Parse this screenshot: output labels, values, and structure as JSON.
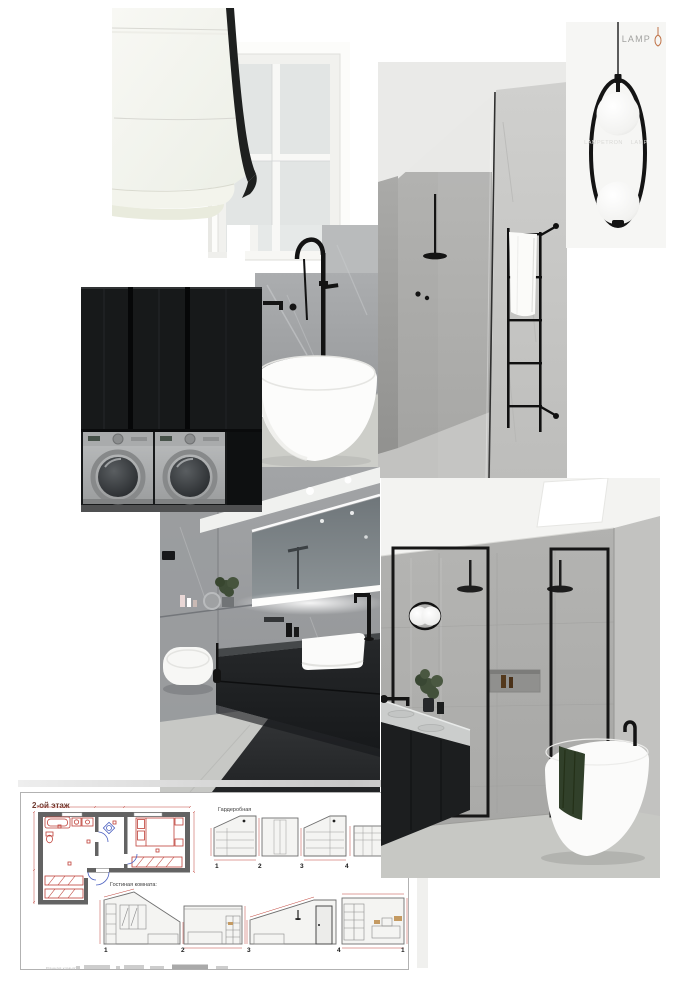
{
  "canvas": {
    "width": 682,
    "height": 990,
    "background": "#ffffff"
  },
  "lamp_card": {
    "watermark_top": "LAMP",
    "watermark_mid_left": "LAMPETRON",
    "watermark_mid_right": "LAMP",
    "background": "#f6f6f4",
    "logo_accent": "#c0744a"
  },
  "floor_plan": {
    "title": "2-ой этаж",
    "labels": {
      "wardrobe": "Гардеробная",
      "living_room": "Гостиная комната:",
      "bathroom": "Ванная комната"
    },
    "wardrobe_numbers": [
      "1",
      "2",
      "3",
      "4"
    ],
    "living_numbers": [
      "1",
      "2",
      "3",
      "4",
      "1"
    ],
    "colors": {
      "walls": "#636363",
      "dimensions": "#bf4038",
      "doors": "#4a5fc0",
      "sheet_border": "#b2b2b2",
      "title": "#6d392e"
    }
  },
  "photos": {
    "roman_blind": {
      "subject": "white roman blind with black trim on window",
      "fabric": "#f5f5f0",
      "trim": "#1e201f"
    },
    "pendant_lamp": {
      "subject": "black hoop pendant with two glass spheres"
    },
    "shower_niche": {
      "subject": "stone shower with glass panel and black towel ladder",
      "stone": "#c6c6c4",
      "fixtures": "#141414"
    },
    "freestanding_tub": {
      "subject": "white oval tub with black floor-mounted filler",
      "marble": "#a4a6a8",
      "tub": "#fcfcfb"
    },
    "laundry_stack": {
      "subject": "black cabinetry with twin front-load washers",
      "cabinet": "#17191a",
      "machine": "#b4b6b7"
    },
    "vanity_bathroom": {
      "subject": "grey marble bath with black floating vanity and LED mirror",
      "vanity": "#232527",
      "sink": "#fbfbfa"
    },
    "skylight_bathroom": {
      "subject": "double shower with skylight and freestanding tub",
      "frames": "#161616",
      "towel": "#31402a"
    }
  }
}
